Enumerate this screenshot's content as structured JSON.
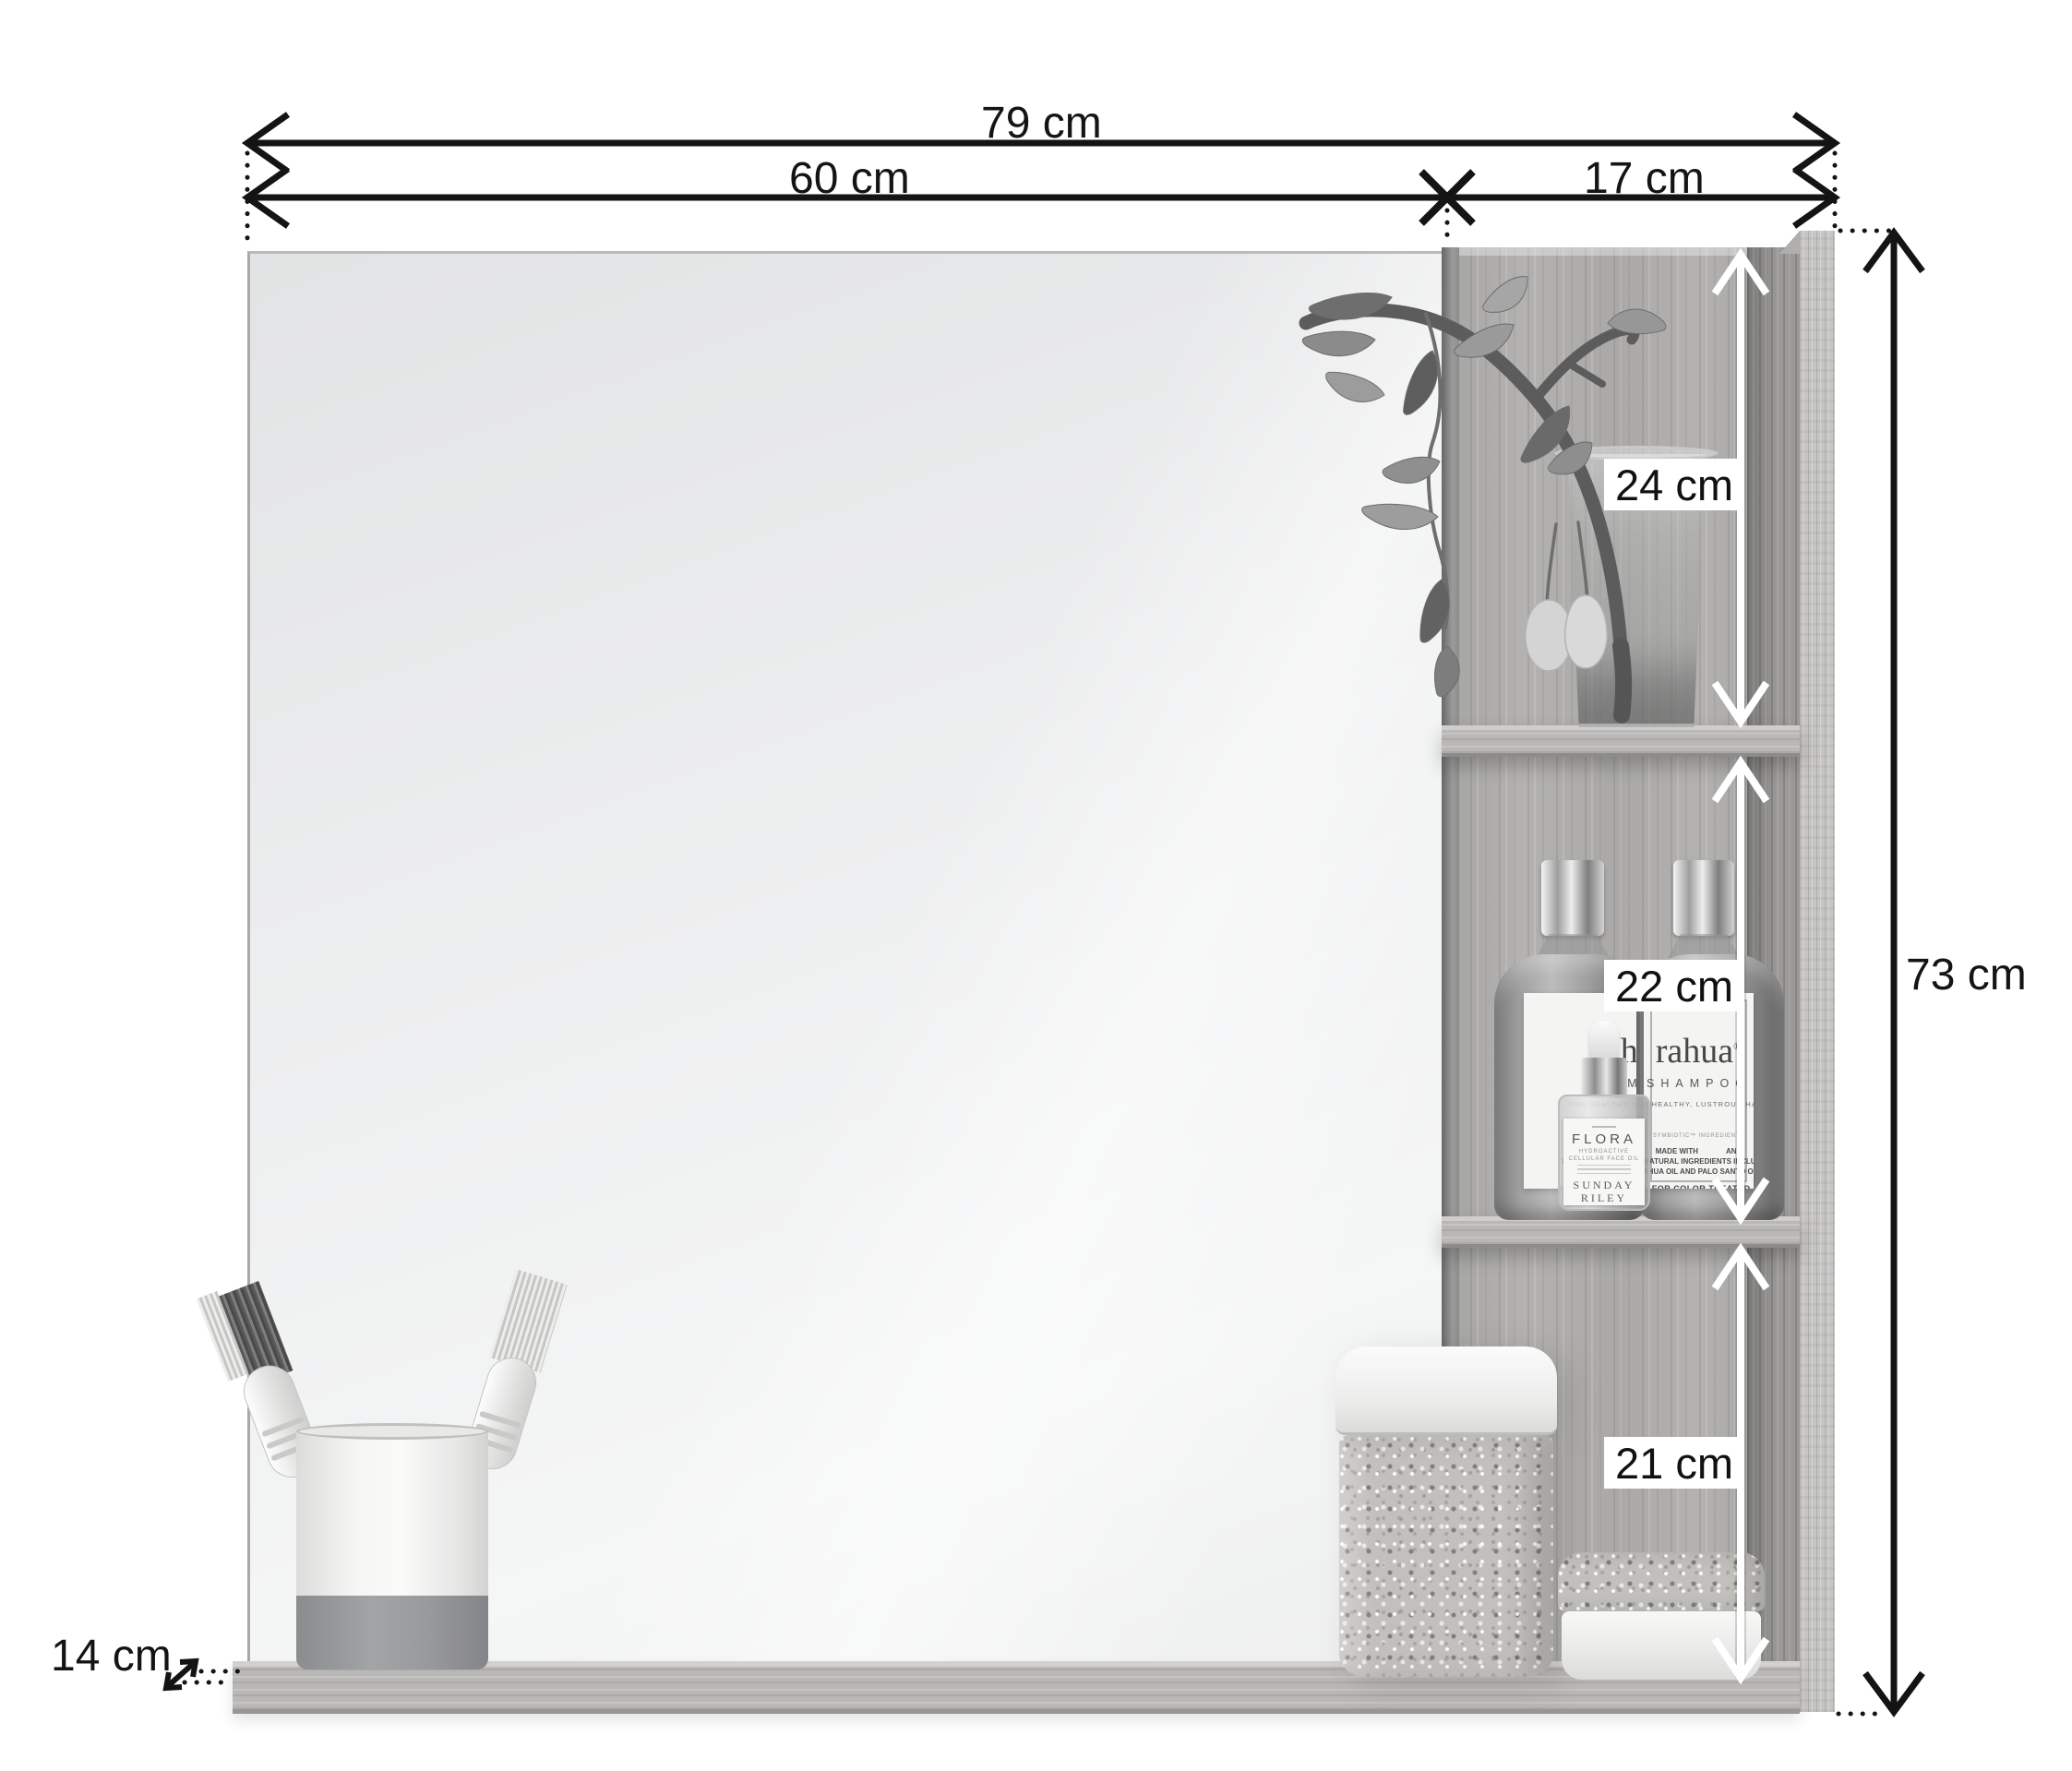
{
  "dimensions": {
    "total_width": "79 cm",
    "mirror_width": "60 cm",
    "shelf_width": "17 cm",
    "total_height": "73 cm",
    "depth": "14 cm",
    "compartment_top": "24 cm",
    "compartment_middle": "22 cm",
    "compartment_bottom": "21 cm"
  },
  "products": {
    "shampoo": {
      "brand": "rahua",
      "trademark": "®",
      "product": "SHAMPOO",
      "tagline": "FOR HEALTHY, LUSTROUS HAIR",
      "note": "SYMBIOTIC™ INGREDIENTS",
      "made_left": "MADE WITH",
      "made_right": "AND",
      "made_line2": "100% NATURAL INGREDIENTS INCLUDING",
      "made_line3": "RAHUA OIL AND PALO SANTO OIL",
      "ideal": "IDEAL FOR COLOR TREATED HAIR",
      "volume": "℮ 275 mL / 9.3 oz"
    },
    "face_oil": {
      "brand": "FLORA",
      "sub1": "HYDROACTIVE",
      "sub2": "CELLULAR FACE OIL",
      "maker_line1": "SUNDAY",
      "maker_line2": "RILEY"
    }
  },
  "colors": {
    "dimension_lines": "#141414",
    "white_arrows": "#ffffff",
    "wood_base": "#b3b2b0",
    "mirror": "#eceded",
    "background": "#ffffff"
  }
}
